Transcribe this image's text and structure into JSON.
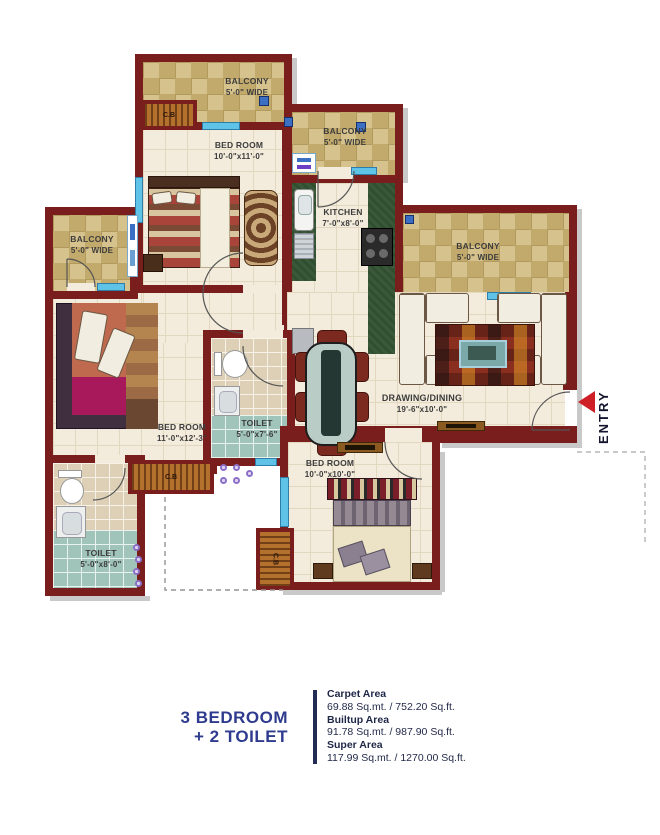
{
  "plan": {
    "rooms": {
      "balcony_top": {
        "name": "BALCONY",
        "dims": "5'-0\" WIDE"
      },
      "balcony_kitchen": {
        "name": "BALCONY",
        "dims": "5'-0\" WIDE"
      },
      "balcony_left": {
        "name": "BALCONY",
        "dims": "5'-0\" WIDE"
      },
      "balcony_right": {
        "name": "BALCONY",
        "dims": "5'-0\" WIDE"
      },
      "bedroom_top": {
        "name": "BED ROOM",
        "dims": "10'-0\"x11'-0\""
      },
      "bedroom_left": {
        "name": "BED ROOM",
        "dims": "11'-0\"x12'-3\""
      },
      "bedroom_bottom": {
        "name": "BED ROOM",
        "dims": "10'-0\"x10'-0\""
      },
      "kitchen": {
        "name": "KITCHEN",
        "dims": "7'-0\"x8'-0\""
      },
      "toilet_mid": {
        "name": "TOILET",
        "dims": "5'-0\"x7'-6\""
      },
      "toilet_left": {
        "name": "TOILET",
        "dims": "5'-0\"x8'-0\""
      },
      "drawing_dining": {
        "name": "DRAWING/DINING",
        "dims": "19'-6\"x10'-0\""
      }
    },
    "cupboard_label": "C.B",
    "entry_label": "ENTRY"
  },
  "summary": {
    "title_line1": "3 BEDROOM",
    "title_line2": "+ 2 TOILET",
    "areas": [
      {
        "label": "Carpet Area",
        "value": "69.88 Sq.mt. / 752.20 Sq.ft."
      },
      {
        "label": "Builtup Area",
        "value": "91.78 Sq.mt. / 987.90 Sq.ft."
      },
      {
        "label": "Super Area",
        "value": "117.99 Sq.mt. / 1270.00 Sq.ft."
      }
    ]
  },
  "colors": {
    "wall": "#7a1d1d",
    "title_blue": "#2e3b8e",
    "entry_arrow_red": "#ce1f26",
    "window_cyan": "#5fc3e8"
  }
}
